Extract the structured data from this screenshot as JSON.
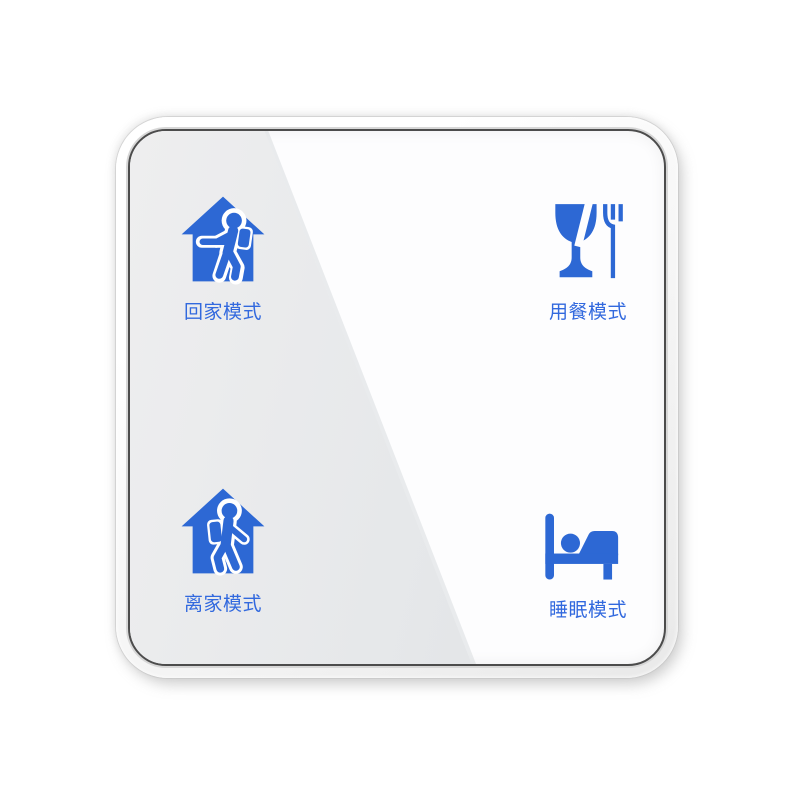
{
  "panel": {
    "name": "smart-scene-switch-panel",
    "buttons": [
      {
        "id": "coming-home",
        "label": "回家模式",
        "icon": "house-person-entering-icon"
      },
      {
        "id": "dining",
        "label": "用餐模式",
        "icon": "glass-and-fork-icon"
      },
      {
        "id": "leaving-home",
        "label": "离家模式",
        "icon": "house-person-leaving-icon"
      },
      {
        "id": "sleep",
        "label": "睡眠模式",
        "icon": "bed-sleep-icon"
      }
    ],
    "colors": {
      "icon_blue": "#2d68d4",
      "label_blue": "#3269de",
      "glass_white": "#fdfdfe",
      "reflection_gray": "#e4e6e8",
      "glass_edge": "#4c4c4c",
      "bezel": "#f3f3f3"
    }
  }
}
